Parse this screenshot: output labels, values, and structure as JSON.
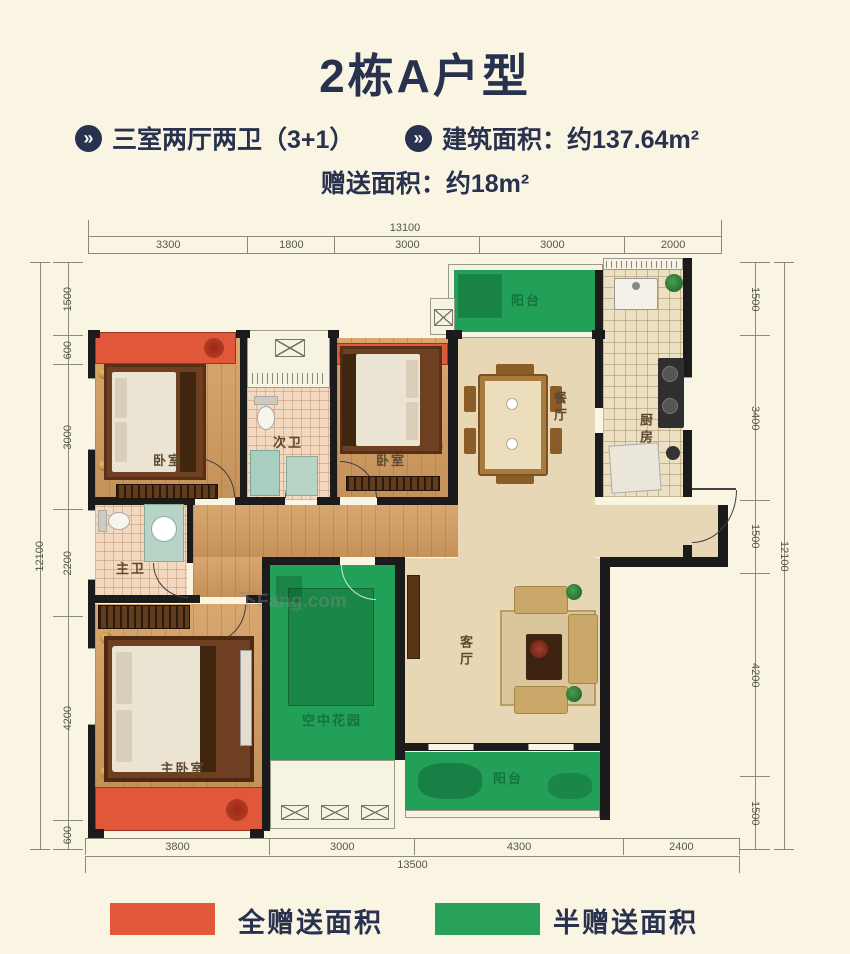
{
  "header": {
    "title": "2栋A户型",
    "bullet_glyph": "»",
    "feature_1": "三室两厅两卫（3+1）",
    "feature_2": "建筑面积：约137.64m²",
    "bonus": "赠送面积：约18m²"
  },
  "rooms": {
    "bedroom1": "卧室",
    "bath2": "次卫",
    "bedroom2": "卧室",
    "dining": "餐厅",
    "balcony_top": "阳台",
    "kitchen": "厨房",
    "bath_master": "主卫",
    "master": "主卧室",
    "sky_garden": "空中花园",
    "living": "客厅",
    "balcony_bottom": "阳台"
  },
  "dimensions": {
    "top": {
      "total": "13100",
      "segments": [
        "3300",
        "1800",
        "3000",
        "3000",
        "2000"
      ]
    },
    "bottom": {
      "total": "13500",
      "segments": [
        "3800",
        "3000",
        "4300",
        "2400"
      ]
    },
    "left": {
      "total": "12100",
      "segments": [
        "1500",
        "600",
        "3000",
        "2200",
        "4200",
        "600"
      ]
    },
    "right": {
      "total": "12100",
      "segments": [
        "1500",
        "3400",
        "1500",
        "4200",
        "1500"
      ]
    }
  },
  "legend": {
    "full": {
      "label": "全赠送面积",
      "color": "#e0573a"
    },
    "half": {
      "label": "半赠送面积",
      "color": "#2aa158"
    }
  },
  "colors": {
    "accent_navy": "#28324f",
    "full_gift_red": "#e0573a",
    "half_gift_green": "#23a057",
    "background": "#faf5e3"
  },
  "watermark": "下Fang.com"
}
